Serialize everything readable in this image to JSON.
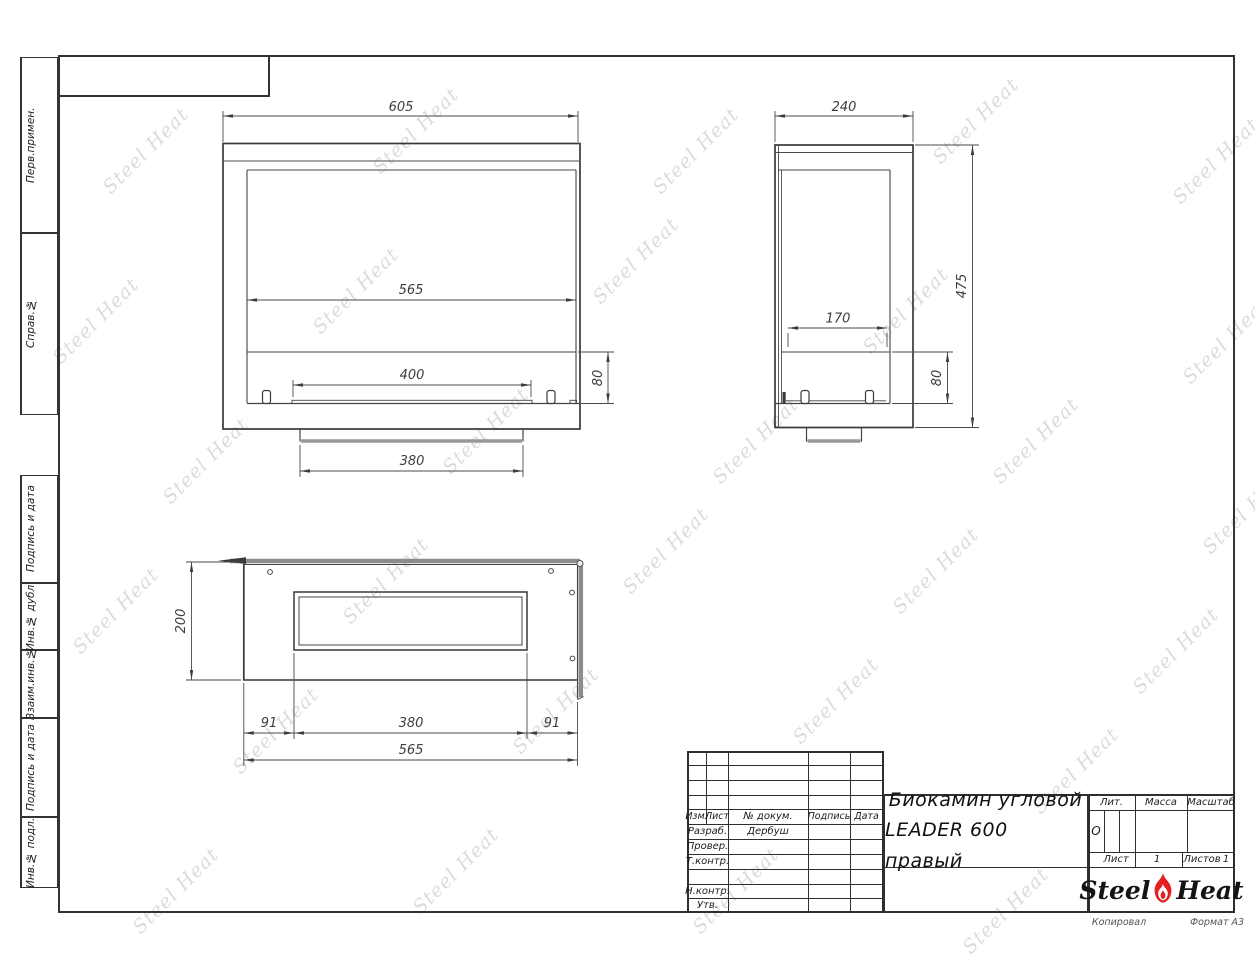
{
  "sheet": {
    "copied_label": "Копировал",
    "format_label": "Формат А3"
  },
  "watermark": {
    "text": "Steel Heat"
  },
  "margin_labels": [
    "Перв.примен.",
    "Справ.№",
    "Подпись и дата",
    "Инв.№ дубл.",
    "Взаим.инв.№",
    "Подпись и дата",
    "Инв.№ подл."
  ],
  "views": {
    "front": {
      "width_total": "605",
      "width_inner": "565",
      "burner_width": "400",
      "band_height": "80",
      "base_width": "380"
    },
    "side": {
      "depth_total": "240",
      "height_total": "475",
      "burner_depth": "170",
      "band_height": "80"
    },
    "top": {
      "depth": "200",
      "offset_left": "91",
      "slot_width": "380",
      "offset_right": "91",
      "width_inner": "565"
    }
  },
  "title_block": {
    "rev_headers": {
      "izm": "Изм.",
      "list": "Лист",
      "doc": "№ докум.",
      "sign": "Подпись",
      "date": "Дата"
    },
    "rows": [
      {
        "label": "Разраб.",
        "value": "Дербуш"
      },
      {
        "label": "Провер.",
        "value": ""
      },
      {
        "label": "Т.контр.",
        "value": ""
      },
      {
        "label": "",
        "value": ""
      },
      {
        "label": "Н.контр.",
        "value": ""
      },
      {
        "label": "Утв.",
        "value": ""
      }
    ],
    "title_line1": "Биокамин угловой",
    "title_line2": "LEADER 600 правый",
    "lit_label": "Лит.",
    "lit_value": "О",
    "mass_label": "Масса",
    "scale_label": "Масштаб",
    "sheet_label": "Лист",
    "sheet_value": "1",
    "sheets_label": "Листов",
    "sheets_value": "1",
    "logo_steel": "Steel",
    "logo_heat": "Heat"
  }
}
